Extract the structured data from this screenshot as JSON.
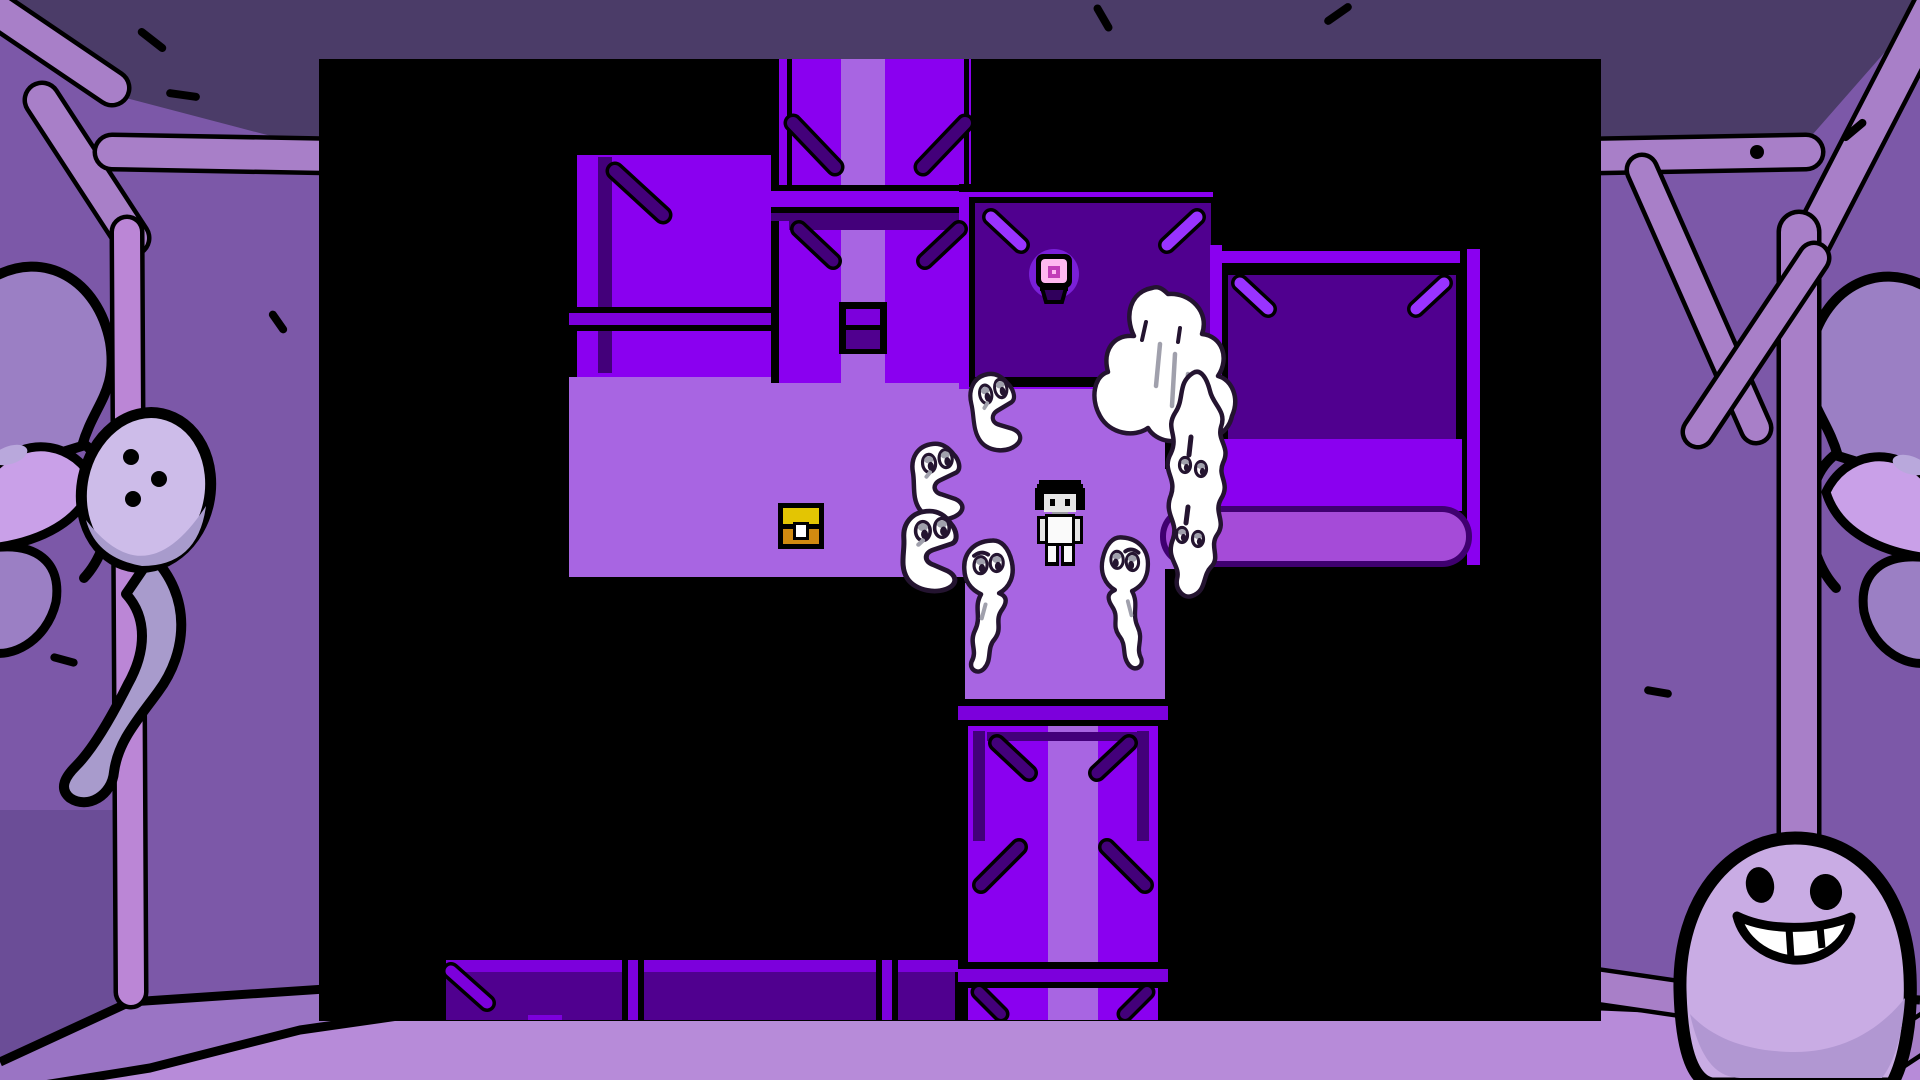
{
  "palette": {
    "K": "#000000",
    "W": "#8A00F0",
    "D": "#50008F",
    "P": "#A865E2",
    "B": "#7C00DC",
    "S": "#43007A",
    "L": "#9933FF",
    "R": "#A54BD8",
    "O": "#3F0070",
    "ceiling": "#4B3C68",
    "wall": "#7C58A8",
    "wallDark": "#6B4D97",
    "pole": "#A87FC8",
    "polePink": "#BB86D6",
    "strip": "#9A74C4",
    "floor": "#B78BD9",
    "faceLight": "#9B7FC4",
    "faceLighter": "#C9A0E8",
    "faceAccent": "#B9A8DC",
    "ghostHead": "#CDBCE9",
    "ghostTail": "#A89BCC",
    "egg": "#C9ACE4",
    "eggShade": "#B197D2",
    "ink": "#000000",
    "spriteInk": "#241430",
    "spriteGray": "#A0A0AC",
    "white": "#FFFFFF",
    "chestGold": "#E3C503",
    "chestOrange": "#D18A10",
    "lampPink": "#FFB8F0",
    "lampMagenta": "#C23EB8",
    "lampGlow": "#7A1FD8",
    "lampBase": "#30005C",
    "skin": "#E6E6E6",
    "shirt": "#FAFAFA",
    "neckShadow": "#9A9AA2"
  },
  "viewport": {
    "x": 319,
    "y": 59,
    "w": 1282,
    "h": 962
  },
  "map": {
    "rects": [
      [
        250,
        318,
        396,
        200,
        "P"
      ],
      [
        646,
        324,
        200,
        320,
        "P"
      ],
      [
        846,
        410,
        47,
        100,
        "P"
      ],
      [
        246,
        312,
        410,
        6,
        "K"
      ],
      [
        244,
        312,
        6,
        212,
        "K"
      ],
      [
        244,
        518,
        410,
        6,
        "K"
      ],
      [
        640,
        318,
        262,
        6,
        "K"
      ],
      [
        250,
        88,
        208,
        230,
        "W"
      ],
      [
        250,
        88,
        208,
        8,
        "K"
      ],
      [
        250,
        88,
        8,
        230,
        "K"
      ],
      [
        279,
        98,
        14,
        216,
        "S"
      ],
      [
        250,
        248,
        208,
        6,
        "K"
      ],
      [
        250,
        254,
        208,
        12,
        "B"
      ],
      [
        250,
        266,
        208,
        6,
        "K"
      ],
      [
        452,
        0,
        8,
        324,
        "K"
      ],
      [
        652,
        0,
        8,
        324,
        "K"
      ],
      [
        460,
        0,
        62,
        324,
        "W"
      ],
      [
        566,
        0,
        86,
        324,
        "W"
      ],
      [
        522,
        0,
        44,
        324,
        "P"
      ],
      [
        468,
        0,
        5,
        126,
        "K"
      ],
      [
        645,
        0,
        5,
        126,
        "K"
      ],
      [
        452,
        126,
        208,
        6,
        "K"
      ],
      [
        452,
        132,
        208,
        16,
        "W"
      ],
      [
        452,
        148,
        208,
        6,
        "K"
      ],
      [
        452,
        154,
        208,
        8,
        "S"
      ],
      [
        470,
        162,
        172,
        9,
        "S"
      ],
      [
        520,
        243,
        48,
        52,
        "K"
      ],
      [
        527,
        250,
        34,
        16,
        "B"
      ],
      [
        527,
        271,
        34,
        19,
        "D"
      ],
      [
        640,
        125,
        262,
        8,
        "K"
      ],
      [
        640,
        133,
        262,
        197,
        "W"
      ],
      [
        894,
        125,
        8,
        205,
        "K"
      ],
      [
        650,
        138,
        248,
        190,
        "K"
      ],
      [
        656,
        144,
        236,
        174,
        "D"
      ],
      [
        895,
        186,
        256,
        6,
        "K"
      ],
      [
        895,
        192,
        256,
        12,
        "W"
      ],
      [
        895,
        204,
        256,
        6,
        "K"
      ],
      [
        891,
        186,
        12,
        266,
        "W"
      ],
      [
        1141,
        190,
        7,
        322,
        "K"
      ],
      [
        1148,
        190,
        13,
        322,
        "W"
      ],
      [
        1161,
        190,
        7,
        322,
        "K"
      ],
      [
        903,
        210,
        240,
        176,
        "K"
      ],
      [
        909,
        216,
        228,
        164,
        "D"
      ],
      [
        903,
        380,
        240,
        72,
        "W"
      ],
      [
        893,
        506,
        268,
        7,
        "K"
      ],
      [
        639,
        640,
        10,
        321,
        "K"
      ],
      [
        839,
        640,
        10,
        321,
        "K"
      ],
      [
        649,
        646,
        80,
        315,
        "W"
      ],
      [
        779,
        646,
        60,
        315,
        "W"
      ],
      [
        729,
        646,
        50,
        315,
        "P"
      ],
      [
        639,
        640,
        210,
        7,
        "K"
      ],
      [
        639,
        647,
        210,
        14,
        "B"
      ],
      [
        639,
        661,
        210,
        6,
        "K"
      ],
      [
        654,
        672,
        12,
        110,
        "S"
      ],
      [
        818,
        672,
        12,
        110,
        "S"
      ],
      [
        668,
        673,
        152,
        9,
        "S"
      ],
      [
        639,
        903,
        210,
        7,
        "K"
      ],
      [
        639,
        910,
        210,
        13,
        "B"
      ],
      [
        639,
        923,
        210,
        6,
        "K"
      ],
      [
        121,
        895,
        518,
        6,
        "K"
      ],
      [
        121,
        901,
        518,
        12,
        "B"
      ],
      [
        121,
        895,
        6,
        66,
        "K"
      ],
      [
        127,
        913,
        176,
        48,
        "D"
      ],
      [
        325,
        913,
        232,
        48,
        "D"
      ],
      [
        579,
        913,
        57,
        48,
        "D"
      ],
      [
        303,
        901,
        6,
        60,
        "K"
      ],
      [
        319,
        901,
        6,
        60,
        "K"
      ],
      [
        557,
        901,
        6,
        60,
        "K"
      ],
      [
        573,
        901,
        6,
        60,
        "K"
      ],
      [
        309,
        901,
        10,
        60,
        "B"
      ],
      [
        563,
        901,
        10,
        60,
        "B"
      ],
      [
        209,
        956,
        34,
        5,
        "B"
      ]
    ],
    "braces": [
      [
        296,
        112,
        344,
        156,
        "S",
        12
      ],
      [
        474,
        64,
        516,
        108,
        "S",
        12
      ],
      [
        646,
        64,
        604,
        108,
        "S",
        12
      ],
      [
        480,
        170,
        514,
        202,
        "S",
        11
      ],
      [
        640,
        170,
        606,
        202,
        "S",
        11
      ],
      [
        672,
        158,
        702,
        186,
        "L",
        11
      ],
      [
        878,
        158,
        848,
        186,
        "L",
        11
      ],
      [
        921,
        224,
        949,
        250,
        "L",
        11
      ],
      [
        1125,
        224,
        1097,
        250,
        "L",
        11
      ],
      [
        678,
        684,
        710,
        714,
        "S",
        11
      ],
      [
        810,
        684,
        778,
        714,
        "S",
        11
      ],
      [
        700,
        788,
        662,
        826,
        "S",
        11
      ],
      [
        788,
        788,
        826,
        826,
        "S",
        11
      ],
      [
        660,
        933,
        682,
        955,
        "S",
        10
      ],
      [
        828,
        933,
        806,
        955,
        "S",
        10
      ],
      [
        132,
        912,
        168,
        944,
        "B",
        11
      ]
    ],
    "rounded_path": {
      "outer": [
        841,
        447,
        312,
        61,
        30
      ],
      "inner": [
        847,
        453,
        300,
        49,
        24
      ]
    }
  },
  "sprites": {
    "chest": {
      "x": 459,
      "y": 444
    },
    "lamp": {
      "x": 735,
      "y": 215
    },
    "character": {
      "x": 716,
      "y": 421
    },
    "ghosts": [
      {
        "type": "side",
        "x": 584,
        "y": 386,
        "sx": 1.0,
        "sy": 1.0,
        "rot": -6
      },
      {
        "type": "side",
        "x": 577,
        "y": 450,
        "sx": 1.12,
        "sy": 1.05,
        "rot": 0
      },
      {
        "type": "side",
        "x": 641,
        "y": 318,
        "sx": 0.93,
        "sy": 1.02,
        "rot": -10
      },
      {
        "type": "cloud",
        "x": 771,
        "y": 223,
        "sx": 1,
        "sy": 1,
        "rot": 0
      },
      {
        "type": "tall",
        "x": 830,
        "y": 312,
        "sx": 1,
        "sy": 1,
        "rot": 0
      },
      {
        "type": "down",
        "x": 640,
        "y": 478,
        "sx": 1,
        "sy": 1,
        "rot": 3
      },
      {
        "type": "down",
        "x": 775,
        "y": 478,
        "sx": 0.95,
        "sy": 1,
        "rot": -3,
        "flip": true
      }
    ]
  },
  "border": {
    "ceiling_points": "0,0 1920,0 1920,12 1792,158 1604,152 332,152 126,98 0,20",
    "wedge": [
      0,
      810,
      122,
      270
    ],
    "strip_path": "M0,1062 L130,1002 L430,982 L1600,980 L1920,1000 L1920,1080 L0,1080 Z",
    "floor_path": "M0,1092 L150,1068 L300,1030 L440,1010 L1600,1006 L1920,1020 L1920,1080 L0,1080 Z",
    "strip_line": "M0,1062 L130,1002 L430,982 L1600,980 L1920,1000",
    "floor_line": "M0,1092 L150,1068 L300,1030 L440,1010 L1600,1006 L1920,1020",
    "poles": [
      {
        "x1": -15,
        "y1": 2,
        "x2": 112,
        "y2": 88,
        "w": 30,
        "c": "pole"
      },
      {
        "x1": 42,
        "y1": 100,
        "x2": 132,
        "y2": 238,
        "w": 30,
        "c": "pole"
      },
      {
        "x1": 112,
        "y1": 152,
        "x2": 335,
        "y2": 156,
        "w": 30,
        "c": "pole"
      },
      {
        "x1": 127,
        "y1": 232,
        "x2": 131,
        "y2": 992,
        "w": 26,
        "c": "polePink"
      },
      {
        "x1": 1592,
        "y1": 156,
        "x2": 1806,
        "y2": 152,
        "w": 30,
        "c": "pole"
      },
      {
        "x1": 1936,
        "y1": 0,
        "x2": 1812,
        "y2": 240,
        "w": 34,
        "c": "pole"
      },
      {
        "x1": 1799,
        "y1": 232,
        "x2": 1799,
        "y2": 1000,
        "w": 36,
        "c": "pole"
      },
      {
        "x1": 1642,
        "y1": 170,
        "x2": 1756,
        "y2": 428,
        "w": 26,
        "c": "pole"
      },
      {
        "x1": 1814,
        "y1": 258,
        "x2": 1698,
        "y2": 432,
        "w": 26,
        "c": "pole"
      },
      {
        "x1": 1594,
        "y1": 986,
        "x2": 1690,
        "y2": 1000,
        "w": 30,
        "c": "pole"
      },
      {
        "x1": 1852,
        "y1": 1080,
        "x2": 1934,
        "y2": 1026,
        "w": 30,
        "c": "pole"
      }
    ],
    "beam_dot": {
      "x": 1757,
      "y": 152,
      "r": 7
    },
    "marks": [
      {
        "x": 152,
        "y": 40,
        "len": 26,
        "rot": 38
      },
      {
        "x": 183,
        "y": 95,
        "len": 26,
        "rot": 8
      },
      {
        "x": 1103,
        "y": 18,
        "len": 22,
        "rot": 60
      },
      {
        "x": 1338,
        "y": 14,
        "len": 24,
        "rot": -35
      },
      {
        "x": 1854,
        "y": 130,
        "len": 22,
        "rot": -40
      },
      {
        "x": 64,
        "y": 660,
        "len": 20,
        "rot": 15
      },
      {
        "x": 1658,
        "y": 692,
        "len": 20,
        "rot": 10
      },
      {
        "x": 278,
        "y": 322,
        "len": 18,
        "rot": 55
      }
    ],
    "pole_ghost": {
      "cx": 146,
      "cy": 490,
      "dots": [
        [
          131,
          457
        ],
        [
          159,
          479
        ],
        [
          133,
          499
        ]
      ]
    },
    "egg_ghost": {
      "cx": 1795,
      "top": 838
    }
  }
}
